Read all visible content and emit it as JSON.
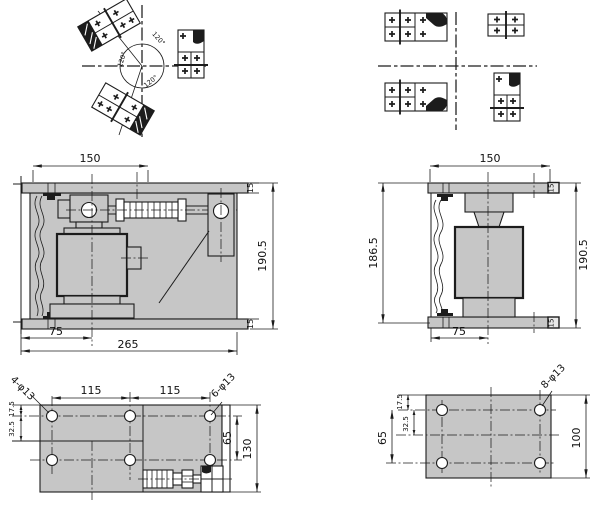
{
  "colors": {
    "plate_fill": "#c6c6c6",
    "line": "#1c1c1c"
  },
  "views": {
    "angular": {
      "angle_1": "120°",
      "angle_2": "120°",
      "angle_3": "120°"
    },
    "front": {
      "top_width": "150",
      "plate_top": "15",
      "height": "190.5",
      "cell_offset": "75",
      "overall_width": "265",
      "plate_bottom": "15"
    },
    "side": {
      "top_width": "150",
      "inner_height": "186.5",
      "height": "190.5",
      "cell_offset": "75",
      "plate_top": "15",
      "plate_bottom": "15"
    },
    "base_left": {
      "holes_corner": "4-φ13",
      "pitch_a": "115",
      "pitch_b": "115",
      "holes_mid": "6-φ13",
      "edge": "17.5",
      "row": "32.5",
      "row_pitch": "65",
      "depth": "130"
    },
    "base_right": {
      "holes": "8-φ13",
      "edge": "17.5",
      "row": "32.5",
      "row_pitch": "65",
      "depth": "100"
    }
  }
}
